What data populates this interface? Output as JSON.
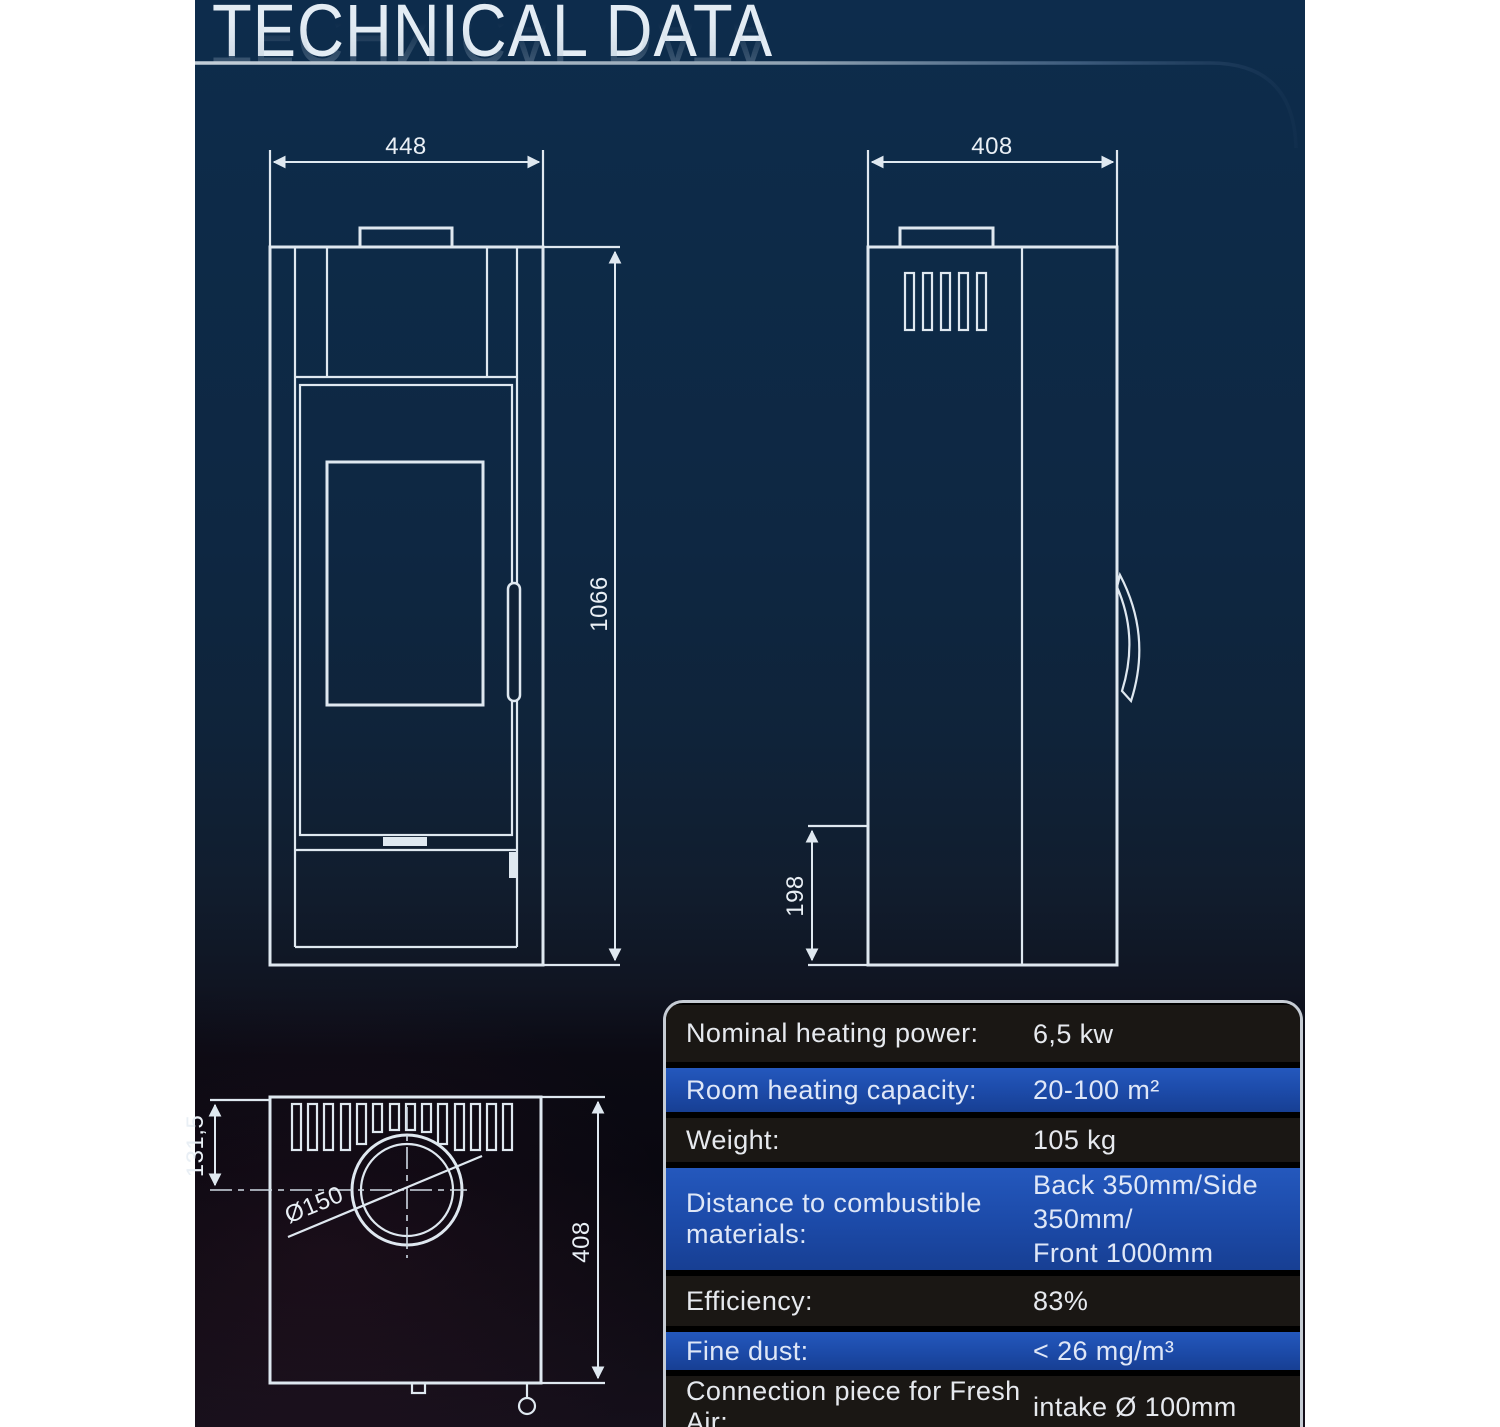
{
  "page": {
    "title": "TECHNICAL DATA"
  },
  "colors": {
    "background_navy": "#0d2a47",
    "page_margin_white": "#ffffff",
    "drawing_line": "#dfe8f0",
    "table_row_blue": "#1c4aa8",
    "table_row_dark": "#1a1714",
    "table_border": "#c6ccd4",
    "title_text": "#e3ecf4"
  },
  "views": {
    "front": {
      "width_dim": "448",
      "height_dim": "1066"
    },
    "side": {
      "depth_dim": "408",
      "base_height_dim": "198"
    },
    "top": {
      "flue_offset_dim": "131,5",
      "depth_dim": "408",
      "flue_diameter": "Ø150"
    }
  },
  "spec_table": {
    "rows": [
      {
        "label": "Nominal heating power:",
        "value": "6,5 kw"
      },
      {
        "label": "Room heating capacity:",
        "value": "20-100 m²"
      },
      {
        "label": "Weight:",
        "value": "105 kg"
      },
      {
        "label": "Distance to combustible materials:",
        "value": "Back 350mm/Side 350mm/",
        "value2": "Front 1000mm"
      },
      {
        "label": "Efficiency:",
        "value": "83%"
      },
      {
        "label": "Fine dust:",
        "value": "< 26 mg/m³"
      },
      {
        "label": "Connection piece for Fresh Air:",
        "value": "intake Ø 100mm"
      },
      {
        "label": "",
        "value": ""
      }
    ]
  }
}
